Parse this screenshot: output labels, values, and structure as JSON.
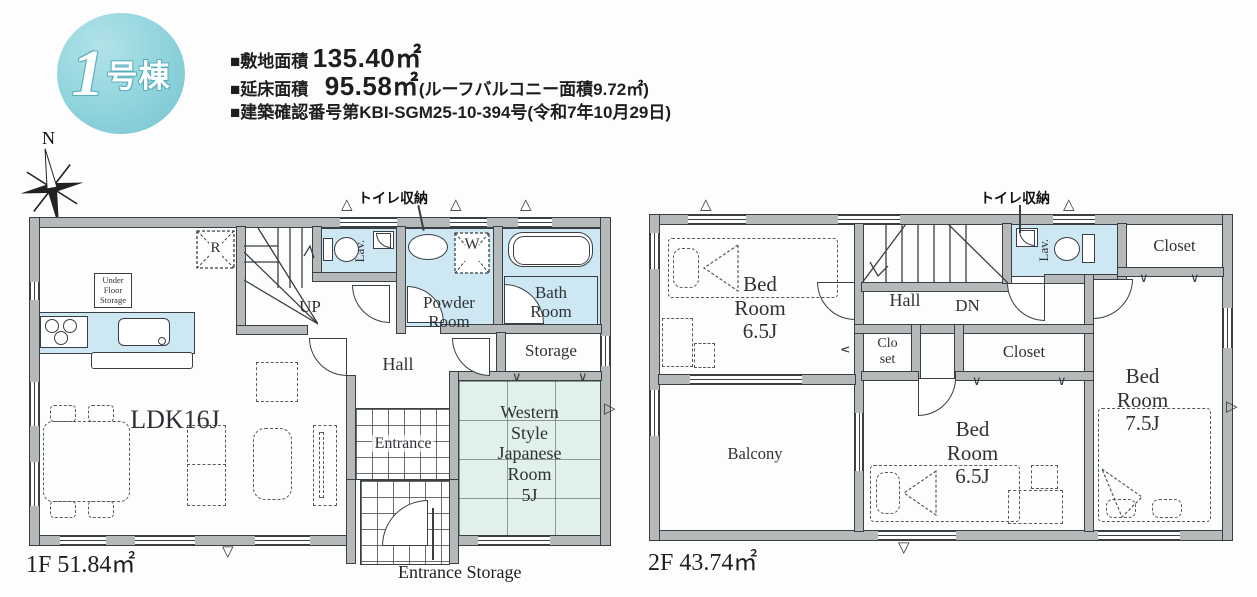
{
  "header": {
    "badge": {
      "number": "1",
      "suffix": "号棟"
    },
    "rows": [
      {
        "label": "■敷地面積",
        "value": "135.40㎡",
        "note": ""
      },
      {
        "label": "■延床面積",
        "value": "95.58㎡",
        "note": "(ルーフバルコニー面積9.72㎡)"
      },
      {
        "label": "■建築確認番号第KBI-SGM25-10-394号(令和7年10月29日)",
        "value": "",
        "note": ""
      }
    ],
    "compass_label": "N"
  },
  "floor1": {
    "area_label": "1F 51.84㎡",
    "rooms": {
      "ldk": "LDK16J",
      "hall": "Hall",
      "stairs": "UP",
      "lav": "Lav.",
      "powder": [
        "Powder",
        "Room"
      ],
      "bath": [
        "Bath",
        "Room"
      ],
      "storage": "Storage",
      "japanese": [
        "Western",
        "Style",
        "Japanese",
        "Room",
        "5J"
      ],
      "entrance": "Entrance",
      "under_floor": [
        "Under",
        "Floor",
        "Storage"
      ],
      "fridge": "R",
      "washer": "W"
    },
    "annotations": {
      "toilet_storage": "トイレ収納",
      "entrance_storage": "Entrance Storage"
    }
  },
  "floor2": {
    "area_label": "2F 43.74㎡",
    "rooms": {
      "bedroom1": [
        "Bed",
        "Room",
        "6.5J"
      ],
      "bedroom2": [
        "Bed",
        "Room",
        "6.5J"
      ],
      "bedroom3": [
        "Bed",
        "Room",
        "7.5J"
      ],
      "hall": "Hall",
      "stairs": "DN",
      "lav": "Lav.",
      "closet1": "Closet",
      "closet2": "Closet",
      "closet_small": [
        "Clo",
        "set"
      ],
      "balcony": "Balcony"
    },
    "annotations": {
      "toilet_storage": "トイレ収納"
    }
  },
  "colors": {
    "wall": "#b5b9b9",
    "line": "#3a3f44",
    "water": "#cde8f2",
    "tatami": "#dff1e9",
    "badge": "#8fd3dc"
  }
}
